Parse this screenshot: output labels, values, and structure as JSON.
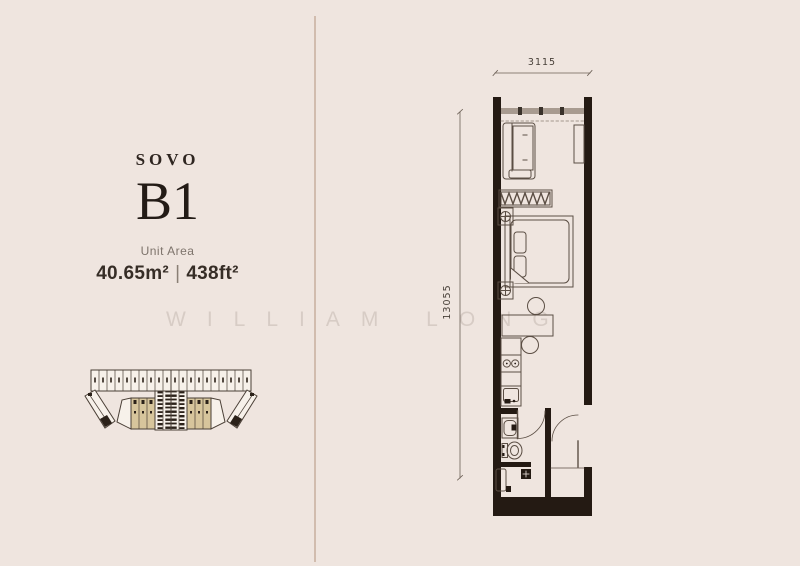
{
  "page": {
    "background": "#efe5df",
    "divider_color": "#c9b2a1"
  },
  "watermark": {
    "text": "WILLIAM LONG"
  },
  "unit_info": {
    "type_label": "SOVO",
    "unit_code": "B1",
    "area_label": "Unit Area",
    "area_sqm": "40.65m²",
    "separator": "|",
    "area_sqft": "438ft²"
  },
  "floor_plan": {
    "width_dim": "3115",
    "height_dim": "13055",
    "wall_color": "#241a13",
    "furniture_line_color": "#5b4e44",
    "window_band_color": "#a89b90"
  },
  "key_plan": {
    "highlight_fill": "#d7c59c",
    "block_fill": "#f7f1ea",
    "outline_color": "#4a3f36"
  }
}
